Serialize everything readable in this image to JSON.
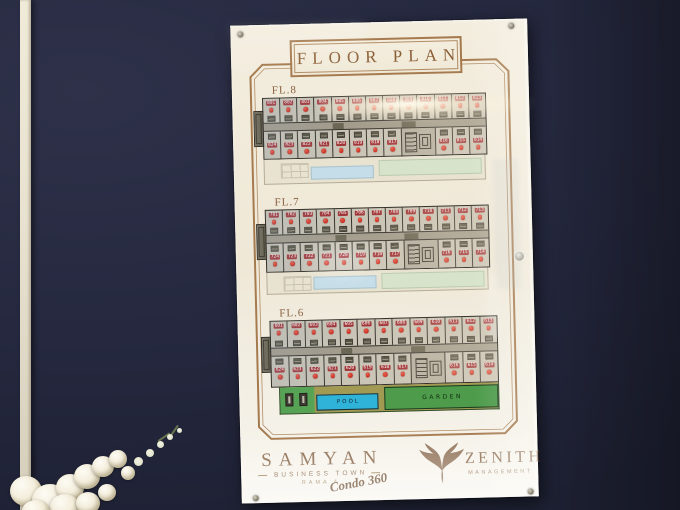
{
  "sign": {
    "title": "FLOOR PLAN",
    "floors": [
      {
        "label": "FL.8",
        "top_units": [
          "801",
          "802",
          "803",
          "804",
          "805",
          "806",
          "807",
          "808",
          "809",
          "810",
          "811",
          "812",
          "813"
        ],
        "bottom_left_units": [
          "824",
          "823",
          "822",
          "821",
          "820",
          "819",
          "818",
          "817"
        ],
        "bottom_right_units": [
          "816",
          "815",
          "814"
        ]
      },
      {
        "label": "FL.7",
        "top_units": [
          "701",
          "702",
          "703",
          "704",
          "705",
          "706",
          "707",
          "708",
          "709",
          "710",
          "711",
          "712",
          "713"
        ],
        "bottom_left_units": [
          "724",
          "723",
          "722",
          "721",
          "720",
          "719",
          "718",
          "717"
        ],
        "bottom_right_units": [
          "716",
          "715",
          "714"
        ]
      },
      {
        "label": "FL.6",
        "top_units": [
          "601",
          "602",
          "603",
          "604",
          "605",
          "606",
          "607",
          "608",
          "609",
          "610",
          "611",
          "612",
          "613"
        ],
        "bottom_left_units": [
          "624",
          "623",
          "622",
          "621",
          "620",
          "619",
          "618",
          "617"
        ],
        "bottom_right_units": [
          "616",
          "615",
          "614"
        ],
        "amenities": {
          "pool": "POOL",
          "garden": "GARDEN"
        }
      }
    ],
    "brand_left": {
      "name": "SAMYAN",
      "line2": "BUSINESS TOWN",
      "line3": "RAMA 4",
      "script": "Condo 360"
    },
    "brand_right": {
      "name": "ZENITH",
      "line2": "MANAGEMENT"
    }
  },
  "colors": {
    "wall": "#262940",
    "trim": "#e8e1cf",
    "board": "#efe8d7",
    "frame_brown": "#a57a4e",
    "title_brown": "#8a5f36",
    "floor_label_brown": "#8a6242",
    "chip_red": "#a03336",
    "dot_red": "#cc2d22",
    "plan_bg": "#c9c4b6",
    "corridor_gray": "#a29b8b",
    "wall_line": "#34312a",
    "substrip_base": "#e8e3d1",
    "substrip_blue": "#c5dde8",
    "substrip_green": "#d7e4cb",
    "pool_blue": "#2fb3d8",
    "garden_green": "#4d9b4b",
    "path_khaki": "#a29a52",
    "deck_green": "#57a356",
    "brand_brown": "#8a6a4e"
  }
}
